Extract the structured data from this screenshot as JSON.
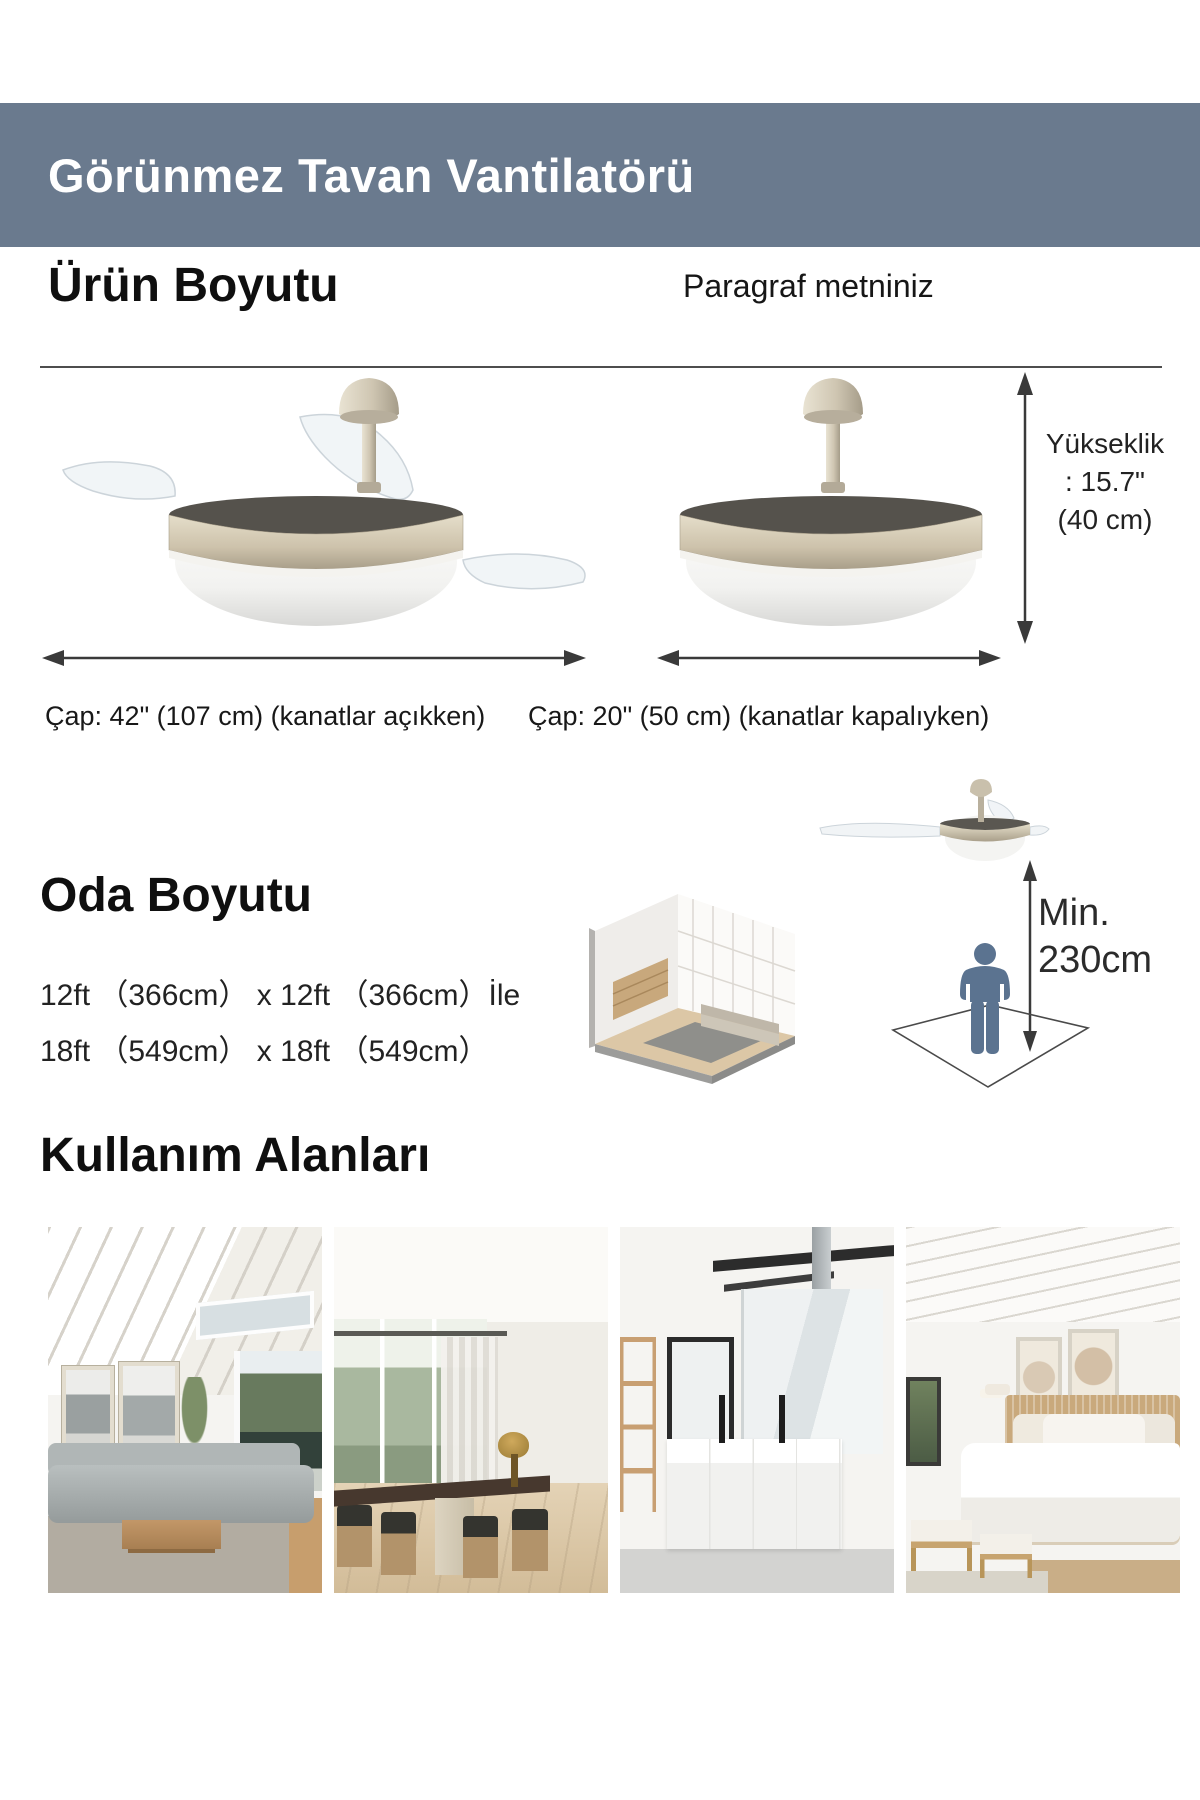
{
  "header": {
    "title": "Görünmez Tavan Vantilatörü",
    "bg_color": "#6a7a8e",
    "text_color": "#ffffff"
  },
  "product_size": {
    "heading": "Ürün Boyutu",
    "note": "Paragraf metniniz",
    "height_lines": [
      "Yükseklik",
      ": 15.7\"",
      "(40 cm)"
    ],
    "diameter_open": "Çap: 42\" (107 cm) (kanatlar açıkken)",
    "diameter_closed": "Çap: 20\" (50 cm) (kanatlar kapalıyken)"
  },
  "room_size": {
    "heading": "Oda Boyutu",
    "line1": "12ft （366cm） x 12ft （366cm）İle",
    "line2": "18ft （549cm） x 18ft （549cm）",
    "min_label": "Min.",
    "min_value": "230cm"
  },
  "usage": {
    "heading": "Kullanım Alanları",
    "photos": [
      "living-room",
      "dining-room",
      "bathroom",
      "bedroom"
    ]
  },
  "colors": {
    "header_bg": "#6a7a8e",
    "arrow": "#3a3a3a",
    "person": "#5b7390",
    "fan_champagne": "#cdc2ab"
  }
}
